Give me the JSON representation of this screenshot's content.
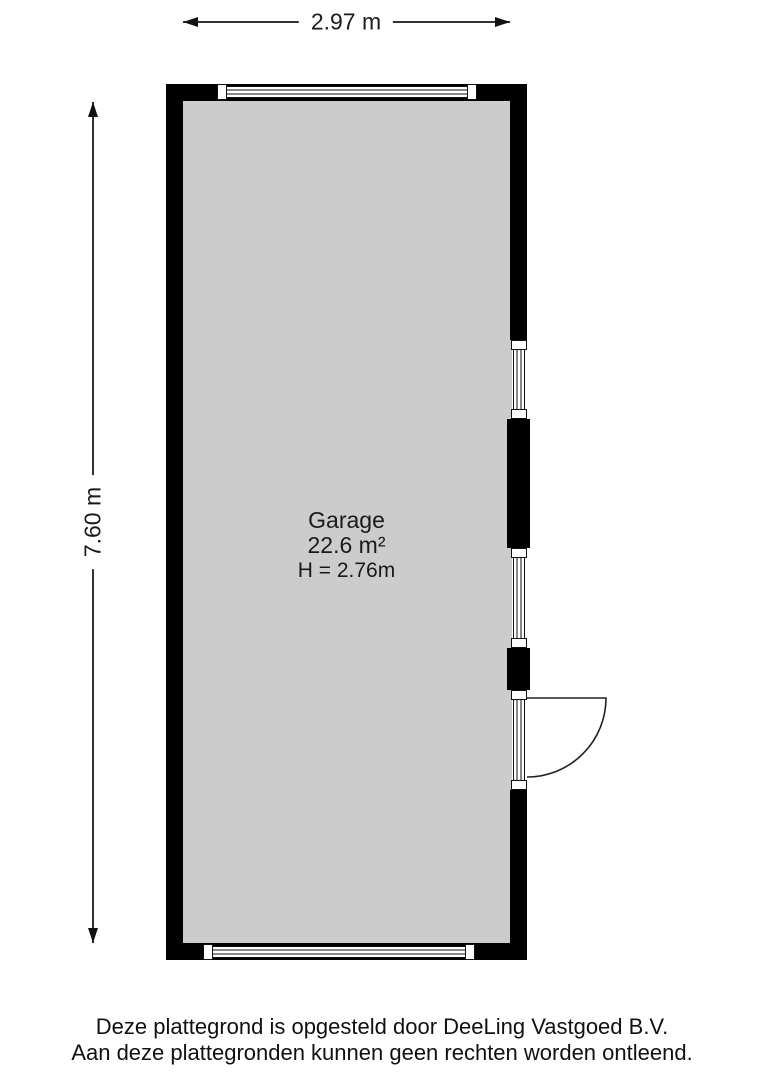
{
  "dimensions": {
    "width_label": "2.97 m",
    "height_label": "7.60 m"
  },
  "room": {
    "name": "Garage",
    "area": "22.6 m²",
    "ceiling_height": "H = 2.76m"
  },
  "footer": {
    "line1": "Deze plattegrond is opgesteld door DeeLing Vastgoed B.V.",
    "line2": "Aan deze plattegronden kunnen geen rechten worden ontleend."
  },
  "colors": {
    "wall": "#000000",
    "floor": "#cccccc",
    "line": "#333333",
    "background": "#ffffff"
  }
}
